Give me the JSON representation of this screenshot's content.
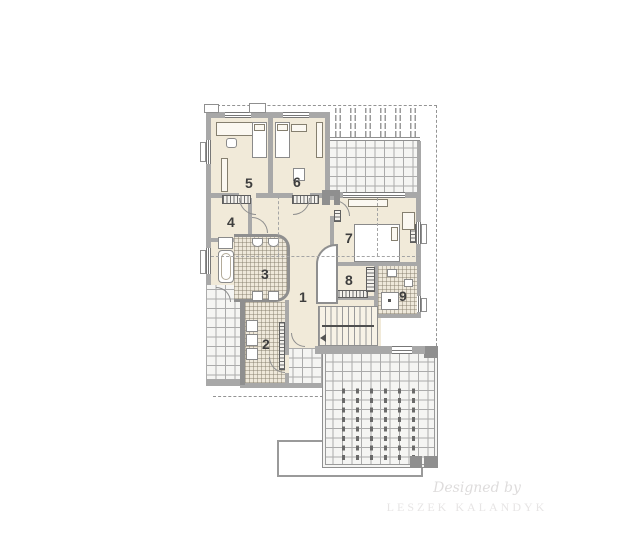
{
  "rooms": {
    "r1": "1",
    "r2": "2",
    "r3": "3",
    "r4": "4",
    "r5": "5",
    "r6": "6",
    "r7": "7",
    "r8": "8",
    "r9": "9"
  },
  "watermark": {
    "line1": "Designed by",
    "line2": "LESZEK KALANDYK"
  },
  "colors": {
    "room_fill": "#f1ead9",
    "wall_gray": "#a8a8a8",
    "tile_line": "#ababab",
    "dashed_outline": "#949494",
    "label_text": "#3e3e3e",
    "watermark_text": "#dedcdc"
  }
}
